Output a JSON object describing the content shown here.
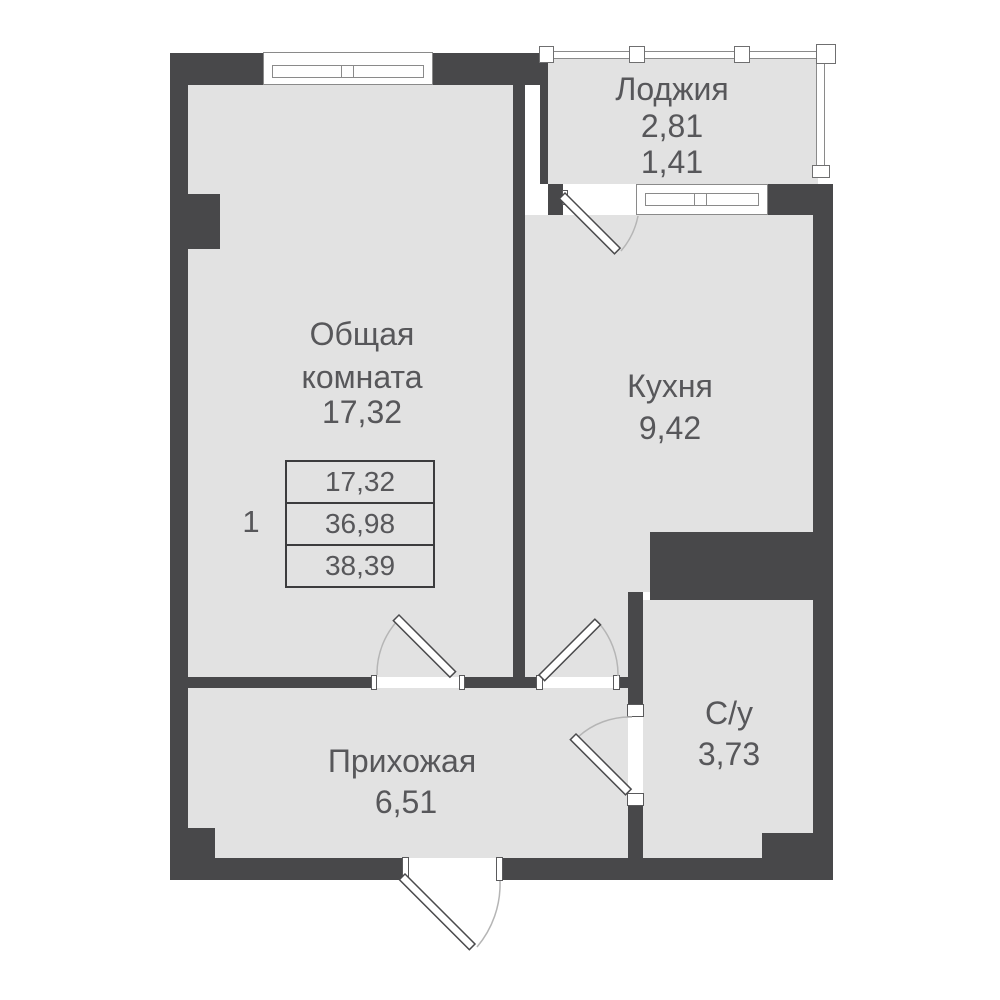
{
  "rooms": {
    "loggia": {
      "name": "Лоджия",
      "area": "2,81",
      "area_reduced": "1,41"
    },
    "living": {
      "name_line1": "Общая",
      "name_line2": "комната",
      "area": "17,32"
    },
    "kitchen": {
      "name": "Кухня",
      "area": "9,42"
    },
    "hallway": {
      "name": "Прихожая",
      "area": "6,51"
    },
    "bathroom": {
      "name": "С/у",
      "area": "3,73"
    }
  },
  "summary": {
    "rooms_count": "1",
    "living_area": "17,32",
    "area_without_loggia": "36,98",
    "total_area": "38,39"
  },
  "colors": {
    "wall": "#48484a",
    "floor": "#e2e2e2",
    "text": "#57575a",
    "background": "#ffffff",
    "frame": "#8a8a8a"
  }
}
